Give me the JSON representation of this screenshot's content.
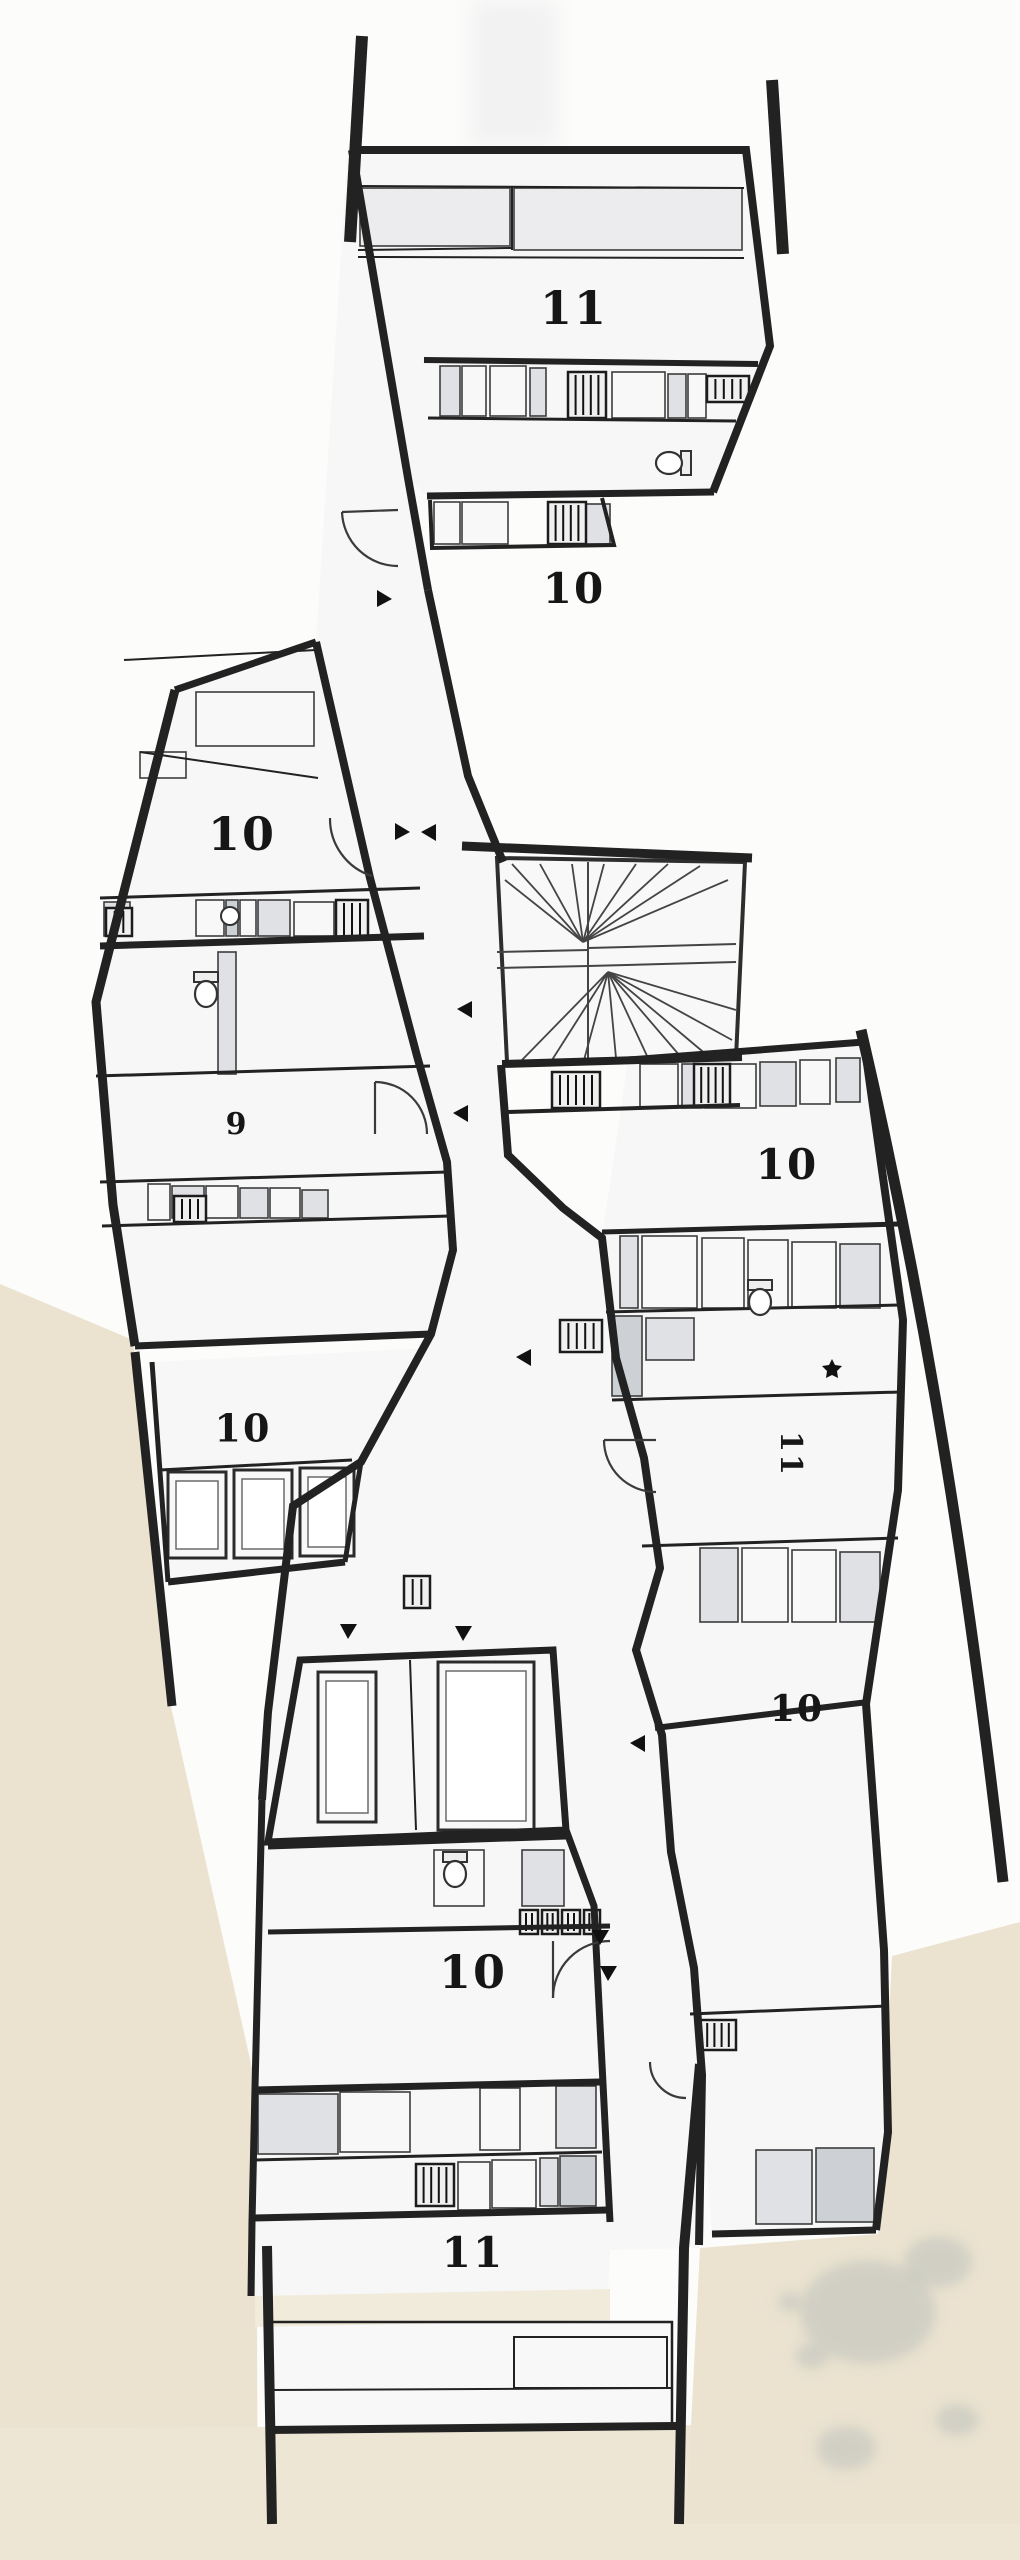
{
  "palette": {
    "paper": "#fcfcfb",
    "room": "#f7f7f8",
    "cell_light": "#ececee",
    "cell_mid": "#dfe1e4",
    "cell_dark": "#cdd0d4",
    "cell_white": "#f8f8f9",
    "wall": "#222222",
    "line": "#3c3c3c",
    "terrain": "#ebe3d0",
    "terrain2": "#ede6d4",
    "strip": "#f1ebdb",
    "blotch": "#b8bdb9",
    "label": "#161616"
  },
  "plan": {
    "type": "architectural-floor-plan",
    "units": [
      {
        "number": "11",
        "x": 574,
        "y": 312,
        "size": 46,
        "a": 0
      },
      {
        "number": "10",
        "x": 574,
        "y": 592,
        "size": 42,
        "a": 0
      },
      {
        "number": "10",
        "x": 242,
        "y": 838,
        "size": 46,
        "a": 0
      },
      {
        "number": "9",
        "x": 237,
        "y": 1126,
        "size": 30,
        "a": 0
      },
      {
        "number": "10",
        "x": 787,
        "y": 1168,
        "size": 42,
        "a": 0
      },
      {
        "number": "10",
        "x": 243,
        "y": 1432,
        "size": 38,
        "a": 0
      },
      {
        "number": "11",
        "x": 789,
        "y": 1454,
        "size": 30,
        "a": 90
      },
      {
        "number": "10",
        "x": 797,
        "y": 1712,
        "size": 36,
        "a": 0
      },
      {
        "number": "10",
        "x": 473,
        "y": 1976,
        "size": 46,
        "a": 0
      },
      {
        "number": "11",
        "x": 473,
        "y": 2256,
        "size": 42,
        "a": 0
      }
    ],
    "terrain": [
      "M0,1284 L133,1340 L170,1702 L256,2086 L258,2560 L0,2560 Z",
      "M0,2428 L1020,2424 L1020,2560 L0,2560 Z",
      "M1020,1922 L892,1956 L878,2234 L700,2248 L686,2524 L1020,2524 Z"
    ],
    "strip": "M255,2296 L610,2289 L610,2320 L255,2327 Z",
    "top_shade": [
      470,
      0,
      88,
      146
    ],
    "blotches": [
      [
        868,
        2312,
        68,
        52
      ],
      [
        938,
        2262,
        34,
        26
      ],
      [
        812,
        2356,
        17,
        13
      ],
      [
        846,
        2448,
        30,
        22
      ],
      [
        957,
        2420,
        22,
        16
      ],
      [
        790,
        2302,
        12,
        10
      ]
    ],
    "fills": [
      {
        "d": "M348,145 L408,480 L428,590 L468,776 L503,862 L501,1065 L508,1155 L563,1208 L602,1238 L616,1358 L644,1458 L660,1568 L636,1650 L662,1735 L671,1852 L694,1968 L702,2075 L699,2248 L610,2250 L608,2292 L255,2298 L256,2086 L262,1800 L268,1712 L293,1506 L361,1462 L431,1334 L453,1250 L447,1162 L417,1056 L370,878 L316,642 Z",
        "f": "room"
      },
      {
        "d": "M352,150 L746,150 L770,346 L713,492 L427,496 L408,478 Z",
        "f": "room"
      },
      {
        "d": "M175,690 L316,642 L370,878 L417,1056 L447,1162 L453,1250 L431,1334 L135,1346 L113,1205 L96,1002 Z",
        "f": "room"
      },
      {
        "d": "M152,1362 L428,1348 L361,1462 L345,1560 L168,1582 Z",
        "f": "room"
      },
      {
        "d": "M300,1660 L553,1650 L566,1830 L268,1842 Z",
        "f": "room"
      },
      {
        "d": "M628,1060 L864,1042 L903,1320 L898,1490 L866,1704 L884,1950 L888,2132 L876,2230 L712,2234 L700,2075 L694,1968 L671,1852 L662,1735 L636,1650 L660,1568 L644,1458 L616,1358 L602,1238 Z",
        "f": "room"
      },
      {
        "d": "M497,858 L745,862 L736,1058 L507,1062 Z",
        "f": "cell_white"
      },
      {
        "d": "M270,2322 L672,2322 L672,2428 L270,2428 Z",
        "f": "cell_white"
      }
    ],
    "walls": [
      {
        "d": "M362,36 L350,242",
        "w": 12
      },
      {
        "d": "M772,80 L783,254",
        "w": 12
      },
      {
        "d": "M352,150 L746,150 L770,346 L713,492",
        "w": 8
      },
      {
        "d": "M352,150 L408,478 L428,590",
        "w": 8
      },
      {
        "d": "M424,360 L758,364",
        "w": 6
      },
      {
        "d": "M427,496 L714,492",
        "w": 7
      },
      {
        "d": "M430,500 L432,548 L614,545 L602,498",
        "w": 4
      },
      {
        "d": "M316,642 L370,878 L417,1056 L447,1162 L453,1250 L431,1334 L361,1462 L293,1506 L268,1712 L262,1800",
        "w": 8
      },
      {
        "d": "M428,590 L468,776 L503,862",
        "w": 8
      },
      {
        "d": "M501,1065 L508,1155 L563,1208 L602,1238 L616,1358 L644,1458 L660,1568 L636,1650 L662,1735 L671,1852 L694,1968 L702,2075 L699,2245",
        "w": 8
      },
      {
        "d": "M175,690 L316,642",
        "w": 7
      },
      {
        "d": "M175,690 L96,1002 L113,1205 L135,1346",
        "w": 9
      },
      {
        "d": "M135,1346 L431,1334",
        "w": 7
      },
      {
        "d": "M135,1352 L172,1706",
        "w": 9
      },
      {
        "d": "M152,1362 L168,1582",
        "w": 5
      },
      {
        "d": "M168,1582 L345,1562",
        "w": 7
      },
      {
        "d": "M345,1562 L361,1462",
        "w": 5
      },
      {
        "d": "M300,1660 L553,1650 L566,1830 L268,1842 Z",
        "w": 7
      },
      {
        "d": "M262,1800 L255,2088 L252,2222 L251,2296",
        "w": 7
      },
      {
        "d": "M566,1830 L594,1906 L610,2222",
        "w": 7
      },
      {
        "d": "M268,1846 L566,1836",
        "w": 7
      },
      {
        "d": "M268,1932 L610,1926",
        "w": 5
      },
      {
        "d": "M255,2090 L600,2082",
        "w": 7
      },
      {
        "d": "M252,2160 L602,2152",
        "w": 3
      },
      {
        "d": "M252,2218 L608,2210",
        "w": 7
      },
      {
        "d": "M268,2430 L676,2426",
        "w": 8
      },
      {
        "d": "M267,2246 L272,2524",
        "w": 10
      },
      {
        "d": "M700,2064 L684,2248 L679,2524",
        "w": 10
      },
      {
        "d": "M861,1030 C915,1262 962,1520 1003,1882",
        "w": 11
      },
      {
        "d": "M628,1060 L864,1042",
        "w": 7
      },
      {
        "d": "M864,1042 L903,1320 L898,1490 L866,1704 L884,1950 L888,2132 L876,2230",
        "w": 8
      },
      {
        "d": "M876,2230 L712,2234",
        "w": 7
      },
      {
        "d": "M602,1232 L899,1224",
        "w": 5
      },
      {
        "d": "M606,1312 L900,1305",
        "w": 3
      },
      {
        "d": "M612,1400 L901,1392",
        "w": 3
      },
      {
        "d": "M642,1546 L898,1538",
        "w": 3
      },
      {
        "d": "M655,1728 L868,1702",
        "w": 6
      },
      {
        "d": "M690,2014 L887,2006",
        "w": 3
      },
      {
        "d": "M462,846 L752,858",
        "w": 9
      },
      {
        "d": "M502,1064 L742,1057",
        "w": 8
      },
      {
        "d": "M506,1112 L740,1105",
        "w": 4
      },
      {
        "d": "M428,418 L736,421",
        "w": 3
      },
      {
        "d": "M100,946 L424,936",
        "w": 7
      },
      {
        "d": "M100,898 L420,888",
        "w": 3
      },
      {
        "d": "M96,1076 L430,1066",
        "w": 3
      },
      {
        "d": "M100,1182 L448,1172",
        "w": 3
      },
      {
        "d": "M102,1226 L450,1216",
        "w": 3
      },
      {
        "d": "M160,1470 L352,1460",
        "w": 3
      },
      {
        "d": "M124,660 L316,650",
        "w": 2
      },
      {
        "d": "M358,186 L744,188",
        "w": 2
      },
      {
        "d": "M358,250 L512,248",
        "w": 2
      },
      {
        "d": "M358,257 L744,258",
        "w": 2
      },
      {
        "d": "M512,186 L512,250",
        "w": 2
      },
      {
        "d": "M140,752 L318,778",
        "w": 2
      },
      {
        "d": "M410,1660 L416,1830",
        "w": 2
      },
      {
        "d": "M270,2322 L672,2322 L672,2428 L270,2428 Z",
        "w": 2.5
      },
      {
        "d": "M272,2390 L672,2388",
        "w": 2
      },
      {
        "d": "M514,2337 L667,2337 L667,2388 L514,2388 Z",
        "w": 2
      }
    ],
    "cells": [
      [
        360,
        188,
        150,
        58,
        "L"
      ],
      [
        514,
        188,
        228,
        62,
        "L"
      ],
      [
        440,
        366,
        20,
        50,
        "M"
      ],
      [
        462,
        366,
        24,
        50,
        "W"
      ],
      [
        490,
        366,
        36,
        50,
        "W"
      ],
      [
        530,
        368,
        16,
        48,
        "M"
      ],
      [
        612,
        372,
        53,
        46,
        "W"
      ],
      [
        668,
        374,
        18,
        44,
        "M"
      ],
      [
        688,
        374,
        18,
        44,
        "W"
      ],
      [
        434,
        502,
        26,
        42,
        "W"
      ],
      [
        462,
        502,
        46,
        42,
        "W"
      ],
      [
        586,
        504,
        24,
        40,
        "M"
      ],
      [
        196,
        692,
        118,
        54,
        "W"
      ],
      [
        140,
        752,
        46,
        26,
        "W"
      ],
      [
        104,
        902,
        26,
        34,
        "M"
      ],
      [
        196,
        900,
        28,
        36,
        "W"
      ],
      [
        226,
        900,
        12,
        36,
        "D"
      ],
      [
        240,
        900,
        16,
        36,
        "W"
      ],
      [
        258,
        900,
        32,
        36,
        "M"
      ],
      [
        294,
        902,
        40,
        34,
        "W"
      ],
      [
        218,
        952,
        18,
        122,
        "M"
      ],
      [
        148,
        1184,
        22,
        36,
        "W"
      ],
      [
        172,
        1186,
        32,
        32,
        "M"
      ],
      [
        206,
        1186,
        32,
        32,
        "W"
      ],
      [
        240,
        1188,
        28,
        30,
        "M"
      ],
      [
        270,
        1188,
        30,
        30,
        "W"
      ],
      [
        302,
        1190,
        26,
        28,
        "M"
      ],
      [
        640,
        1064,
        38,
        44,
        "W"
      ],
      [
        682,
        1064,
        20,
        44,
        "M"
      ],
      [
        704,
        1064,
        52,
        44,
        "W"
      ],
      [
        760,
        1062,
        36,
        44,
        "M"
      ],
      [
        800,
        1060,
        30,
        44,
        "W"
      ],
      [
        836,
        1058,
        24,
        44,
        "M"
      ],
      [
        620,
        1236,
        18,
        72,
        "M"
      ],
      [
        642,
        1236,
        55,
        72,
        "W"
      ],
      [
        702,
        1238,
        42,
        70,
        "W"
      ],
      [
        748,
        1240,
        40,
        68,
        "W"
      ],
      [
        792,
        1242,
        44,
        66,
        "W"
      ],
      [
        840,
        1244,
        40,
        64,
        "M"
      ],
      [
        612,
        1316,
        30,
        80,
        "D"
      ],
      [
        646,
        1318,
        48,
        42,
        "M"
      ],
      [
        700,
        1548,
        38,
        74,
        "M"
      ],
      [
        742,
        1548,
        46,
        74,
        "W"
      ],
      [
        792,
        1550,
        44,
        72,
        "W"
      ],
      [
        840,
        1552,
        40,
        70,
        "M"
      ],
      [
        756,
        2150,
        56,
        74,
        "M"
      ],
      [
        816,
        2148,
        58,
        74,
        "D"
      ],
      [
        434,
        1850,
        50,
        56,
        "W"
      ],
      [
        522,
        1850,
        42,
        56,
        "M"
      ],
      [
        258,
        2094,
        80,
        60,
        "M"
      ],
      [
        340,
        2092,
        70,
        60,
        "W"
      ],
      [
        480,
        2088,
        40,
        62,
        "W"
      ],
      [
        556,
        2086,
        40,
        62,
        "M"
      ],
      [
        458,
        2162,
        32,
        48,
        "W"
      ],
      [
        492,
        2160,
        44,
        48,
        "W"
      ],
      [
        540,
        2158,
        18,
        48,
        "M"
      ],
      [
        560,
        2156,
        36,
        50,
        "D"
      ]
    ],
    "windows": [
      [
        168,
        1472,
        58,
        86
      ],
      [
        234,
        1470,
        58,
        88
      ],
      [
        300,
        1468,
        54,
        88
      ],
      [
        318,
        1672,
        58,
        150
      ],
      [
        438,
        1662,
        96,
        168
      ]
    ],
    "hatches": [
      [
        568,
        372,
        38,
        46
      ],
      [
        707,
        376,
        42,
        26
      ],
      [
        548,
        502,
        38,
        42
      ],
      [
        336,
        900,
        32,
        38
      ],
      [
        106,
        908,
        26,
        28
      ],
      [
        552,
        1072,
        48,
        36
      ],
      [
        560,
        1320,
        42,
        32
      ],
      [
        174,
        1196,
        32,
        26
      ],
      [
        416,
        2164,
        38,
        42
      ],
      [
        694,
        1064,
        36,
        42
      ],
      [
        404,
        1576,
        26,
        32
      ],
      [
        700,
        2020,
        36,
        30
      ],
      [
        520,
        1910,
        18,
        24
      ],
      [
        542,
        1910,
        16,
        24
      ],
      [
        562,
        1910,
        18,
        24
      ],
      [
        584,
        1910,
        16,
        24
      ]
    ],
    "door_arcs": [
      "M342,512 A56,56 0 0 0 398,566",
      "M398,510 L342,512",
      "M330,818 A60,60 0 0 0 372,876",
      "M375,1082 A52,52 0 0 1 427,1134",
      "M375,1082 L375,1134",
      "M604,1440 A52,52 0 0 0 656,1492",
      "M604,1440 L656,1440",
      "M553,1998 A57,57 0 0 1 610,1941",
      "M553,1941 L553,1998",
      "M650,2062 A36,36 0 0 0 686,2098"
    ],
    "toilets": [
      [
        673,
        463,
        90
      ],
      [
        206,
        990,
        0
      ],
      [
        760,
        1298,
        0
      ],
      [
        455,
        1870,
        0
      ]
    ],
    "sinks": [
      [
        230,
        916,
        9
      ]
    ],
    "triangles": [
      [
        377,
        598,
        0
      ],
      [
        395,
        831,
        0
      ],
      [
        436,
        833,
        180
      ],
      [
        472,
        1010,
        180
      ],
      [
        468,
        1114,
        180
      ],
      [
        531,
        1358,
        180
      ],
      [
        349,
        1624,
        90
      ],
      [
        464,
        1626,
        90
      ],
      [
        645,
        1744,
        180
      ],
      [
        601,
        1930,
        90
      ],
      [
        609,
        1966,
        90
      ]
    ],
    "star": [
      832,
      1368
    ],
    "stairs": {
      "outline": "M497,858 L745,862 L736,1058 L507,1062 Z",
      "lines": [
        "M588,862 L588,1058",
        "M497,952 L588,950",
        "M497,968 L588,966",
        "M588,948 L736,944",
        "M588,966 L736,962"
      ],
      "fan1": {
        "c": [
          583,
          942
        ],
        "pts": [
          [
            505,
            880
          ],
          [
            512,
            864
          ],
          [
            540,
            864
          ],
          [
            572,
            864
          ],
          [
            604,
            864
          ],
          [
            636,
            864
          ],
          [
            668,
            864
          ],
          [
            700,
            866
          ],
          [
            728,
            880
          ]
        ]
      },
      "fan2": {
        "c": [
          608,
          972
        ],
        "pts": [
          [
            522,
            1060
          ],
          [
            552,
            1060
          ],
          [
            584,
            1060
          ],
          [
            616,
            1058
          ],
          [
            648,
            1058
          ],
          [
            680,
            1056
          ],
          [
            708,
            1056
          ],
          [
            732,
            1040
          ],
          [
            736,
            1010
          ]
        ]
      }
    }
  }
}
